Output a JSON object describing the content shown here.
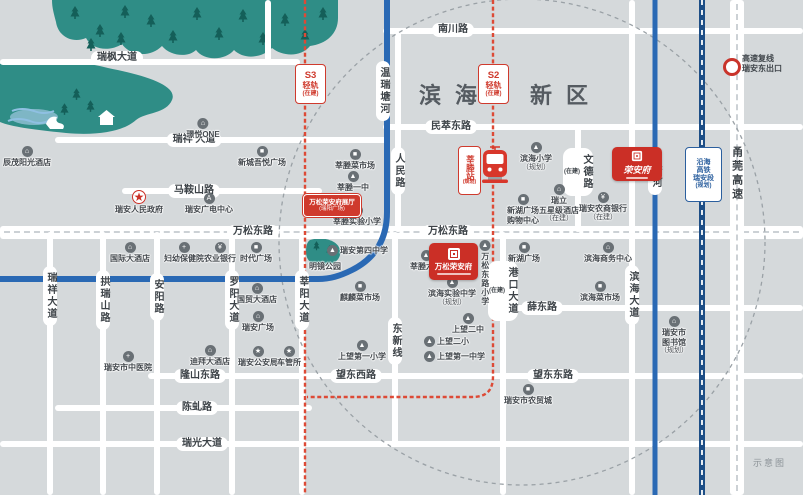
{
  "map": {
    "region": {
      "full": "滨海新区",
      "part1": "滨海",
      "part2": "新区"
    },
    "corner_note": "示意图",
    "exit": {
      "line1": "高速复线",
      "line2": "瑞安东出口"
    },
    "project": {
      "name": "万松荣安府"
    },
    "logo": {
      "name": "荣安府"
    },
    "colors": {
      "accent_red": "#cb2f26",
      "rail_red": "#dd4a36",
      "river_blue": "#2a69b4",
      "hsr_navy": "#1d4e86",
      "forest_teal": "#2f8d86",
      "land_gray": "#d5d9db",
      "road_white": "#ffffff",
      "badge_blue": "#2b5f9e",
      "text_dark": "#3d4348"
    },
    "icon_glyphs": {
      "building": "⌂",
      "hotel": "⌂",
      "mall": "■",
      "market": "■",
      "school": "▲",
      "bank": "¥",
      "hospital": "+",
      "star": "★",
      "media": "A",
      "library": "⌂",
      "gov": "★"
    },
    "road_labels": [
      {
        "t": "瑞枫大道",
        "x": 117,
        "y": 58
      },
      {
        "t": "瑞祥 大道",
        "x": 194,
        "y": 140
      },
      {
        "t": "马鞍山路",
        "x": 194,
        "y": 191
      },
      {
        "t": "南川路",
        "x": 453,
        "y": 30
      },
      {
        "t": "民萃东路",
        "x": 451,
        "y": 127
      },
      {
        "t": "万松东路",
        "x": 253,
        "y": 232
      },
      {
        "t": "万松东路",
        "x": 448,
        "y": 232
      },
      {
        "t": "薛东路",
        "x": 542,
        "y": 308
      },
      {
        "t": "隆山东路",
        "x": 200,
        "y": 376
      },
      {
        "t": "望东西路",
        "x": 356,
        "y": 376
      },
      {
        "t": "望东东路",
        "x": 553,
        "y": 376
      },
      {
        "t": "陈虬路",
        "x": 197,
        "y": 408
      },
      {
        "t": "瑞光大道",
        "x": 202,
        "y": 444
      },
      {
        "t": "瑞祥大道",
        "x": 50,
        "y": 296,
        "v": 1
      },
      {
        "t": "拱瑞山路",
        "x": 103,
        "y": 300,
        "v": 1
      },
      {
        "t": "安阳路",
        "x": 157,
        "y": 297,
        "v": 1
      },
      {
        "t": "罗阳大道",
        "x": 232,
        "y": 300,
        "v": 1
      },
      {
        "t": "莘阳大道",
        "x": 302,
        "y": 300,
        "v": 1
      },
      {
        "t": "人民路",
        "x": 398,
        "y": 171,
        "v": 1
      },
      {
        "t": "温瑞塘河",
        "x": 383,
        "y": 91,
        "v": 1
      },
      {
        "t": "文德路",
        "x": 578,
        "y": 172,
        "v": 1,
        "sub": "(在建)"
      },
      {
        "t": "港口大道",
        "x": 503,
        "y": 291,
        "v": 1,
        "sub": "(在建)"
      },
      {
        "t": "东新线",
        "x": 395,
        "y": 341,
        "v": 1
      },
      {
        "t": "滨海大道",
        "x": 632,
        "y": 295,
        "v": 1
      },
      {
        "t": "中塘河",
        "x": 655,
        "y": 171,
        "v": 1
      },
      {
        "t": "甬莞高速",
        "x": 736,
        "y": 174,
        "v": 1,
        "plain": 1
      }
    ],
    "pois": [
      {
        "t": [
          "璟悦ONE"
        ],
        "x": 203,
        "y": 118,
        "ic": "building"
      },
      {
        "t": [
          "辰茂阳光酒店"
        ],
        "x": 27,
        "y": 146,
        "ic": "hotel"
      },
      {
        "t": [
          "新城吾悦广场"
        ],
        "x": 262,
        "y": 146,
        "ic": "mall"
      },
      {
        "t": [
          "瑞安人民政府"
        ],
        "x": 139,
        "y": 190,
        "ic": "gov"
      },
      {
        "t": [
          "瑞安广电中心"
        ],
        "x": 209,
        "y": 193,
        "ic": "media"
      },
      {
        "t": [
          "国际大酒店"
        ],
        "x": 130,
        "y": 242,
        "ic": "hotel"
      },
      {
        "t": [
          "妇幼保健院"
        ],
        "x": 184,
        "y": 242,
        "ic": "hospital"
      },
      {
        "t": [
          "农业银行"
        ],
        "x": 220,
        "y": 242,
        "ic": "bank"
      },
      {
        "t": [
          "时代广场"
        ],
        "x": 256,
        "y": 242,
        "ic": "mall"
      },
      {
        "t": [
          "国贸大酒店"
        ],
        "x": 257,
        "y": 283,
        "ic": "hotel"
      },
      {
        "t": [
          "瑞安广场"
        ],
        "x": 258,
        "y": 311,
        "ic": "building"
      },
      {
        "t": [
          "瑞安市中医院"
        ],
        "x": 128,
        "y": 351,
        "ic": "hospital"
      },
      {
        "t": [
          "迪拜大酒店"
        ],
        "x": 210,
        "y": 345,
        "ic": "hotel"
      },
      {
        "t": [
          "瑞安公安局"
        ],
        "x": 258,
        "y": 346,
        "ic": "star"
      },
      {
        "t": [
          "车管所"
        ],
        "x": 289,
        "y": 346,
        "ic": "star"
      },
      {
        "t": [
          "莘塍菜市场"
        ],
        "x": 355,
        "y": 149,
        "ic": "market"
      },
      {
        "t": [
          "莘塍一中"
        ],
        "x": 353,
        "y": 171,
        "ic": "school"
      },
      {
        "t": [
          "莘塍实验小学"
        ],
        "x": 357,
        "y": 205,
        "ic": "school"
      },
      {
        "t": [
          "莘塍六小"
        ],
        "x": 426,
        "y": 250,
        "ic": "school"
      },
      {
        "t": [
          "瑞安第四中学"
        ],
        "x": 327,
        "y": 245,
        "ic": "school",
        "r": 1
      },
      {
        "t": [
          "明镜公园"
        ],
        "x": 325,
        "y": 262,
        "pl": 1
      },
      {
        "t": [
          "麒麟菜市场"
        ],
        "x": 360,
        "y": 281,
        "ic": "market"
      },
      {
        "t": [
          "万松东路小学"
        ],
        "x": 485,
        "y": 240,
        "ic": "school",
        "vt": 1
      },
      {
        "t": [
          "滨海实验中学",
          "（规划）"
        ],
        "x": 452,
        "y": 277,
        "ic": "school"
      },
      {
        "t": [
          "上望二中"
        ],
        "x": 468,
        "y": 313,
        "ic": "school"
      },
      {
        "t": [
          "上望二小"
        ],
        "x": 424,
        "y": 336,
        "ic": "school",
        "r": 1
      },
      {
        "t": [
          "上望第一中学"
        ],
        "x": 424,
        "y": 351,
        "ic": "school",
        "r": 1
      },
      {
        "t": [
          "上望第一小学"
        ],
        "x": 362,
        "y": 340,
        "ic": "school"
      },
      {
        "t": [
          "滨海小学",
          "（规划）"
        ],
        "x": 536,
        "y": 142,
        "ic": "school"
      },
      {
        "t": [
          "新湖广场",
          "购物中心"
        ],
        "x": 523,
        "y": 194,
        "ic": "mall"
      },
      {
        "t": [
          "瑞立",
          "五星级酒店",
          "（在建）"
        ],
        "x": 559,
        "y": 184,
        "ic": "building"
      },
      {
        "t": [
          "瑞安农商银行",
          "（在建）"
        ],
        "x": 603,
        "y": 192,
        "ic": "bank"
      },
      {
        "t": [
          "新湖广场"
        ],
        "x": 524,
        "y": 242,
        "ic": "mall"
      },
      {
        "t": [
          "滨海商务中心"
        ],
        "x": 608,
        "y": 242,
        "ic": "building"
      },
      {
        "t": [
          "滨海菜市场"
        ],
        "x": 600,
        "y": 281,
        "ic": "market"
      },
      {
        "t": [
          "瑞安市",
          "图书馆",
          "（规划）"
        ],
        "x": 674,
        "y": 316,
        "ic": "library"
      },
      {
        "t": [
          "瑞安市农贸城"
        ],
        "x": 528,
        "y": 384,
        "ic": "market"
      }
    ],
    "badges": [
      {
        "lines": [
          "S3",
          "轻轨",
          "(在建)"
        ],
        "x": 295,
        "y": 64,
        "w": 29,
        "h": 38,
        "style": "red"
      },
      {
        "lines": [
          "S2",
          "轻轨",
          "(在建)"
        ],
        "x": 478,
        "y": 64,
        "w": 29,
        "h": 38,
        "style": "red"
      },
      {
        "lines": [
          "沿海",
          "高铁",
          "瑞安段",
          "(规划)"
        ],
        "x": 685,
        "y": 147,
        "w": 35,
        "h": 53,
        "style": "blue"
      },
      {
        "lines": [
          "莘塍站",
          "(规划)"
        ],
        "x": 458,
        "y": 146,
        "w": 21,
        "h": 47,
        "style": "station"
      },
      {
        "lines": [
          "万松荣安府展厅",
          "(瑞阳广场)"
        ],
        "x": 303,
        "y": 194,
        "w": 56,
        "h": 21,
        "style": "hall"
      }
    ],
    "geometry": {
      "h_roads": [
        {
          "y": 62,
          "x1": 0,
          "x2": 300
        },
        {
          "y": 140,
          "x1": 55,
          "x2": 390
        },
        {
          "y": 191,
          "x1": 122,
          "x2": 322
        },
        {
          "y": 31,
          "x1": 383,
          "x2": 803
        },
        {
          "y": 127,
          "x1": 383,
          "x2": 803
        },
        {
          "y": 232,
          "x1": 0,
          "x2": 803,
          "major": 1
        },
        {
          "y": 308,
          "x1": 495,
          "x2": 803
        },
        {
          "y": 376,
          "x1": 148,
          "x2": 803
        },
        {
          "y": 408,
          "x1": 55,
          "x2": 312
        },
        {
          "y": 444,
          "x1": 0,
          "x2": 803
        }
      ],
      "v_roads": [
        {
          "x": 268,
          "y1": 0,
          "y2": 62
        },
        {
          "x": 50,
          "y1": 232,
          "y2": 495
        },
        {
          "x": 103,
          "y1": 232,
          "y2": 495
        },
        {
          "x": 157,
          "y1": 232,
          "y2": 495
        },
        {
          "x": 232,
          "y1": 232,
          "y2": 495
        },
        {
          "x": 302,
          "y1": 232,
          "y2": 495
        },
        {
          "x": 398,
          "y1": 31,
          "y2": 232
        },
        {
          "x": 578,
          "y1": 127,
          "y2": 232
        },
        {
          "x": 503,
          "y1": 232,
          "y2": 495
        },
        {
          "x": 632,
          "y1": 0,
          "y2": 495
        },
        {
          "x": 395,
          "y1": 232,
          "y2": 444
        },
        {
          "x": 737,
          "y1": 0,
          "y2": 495,
          "major": 1
        }
      ]
    }
  }
}
